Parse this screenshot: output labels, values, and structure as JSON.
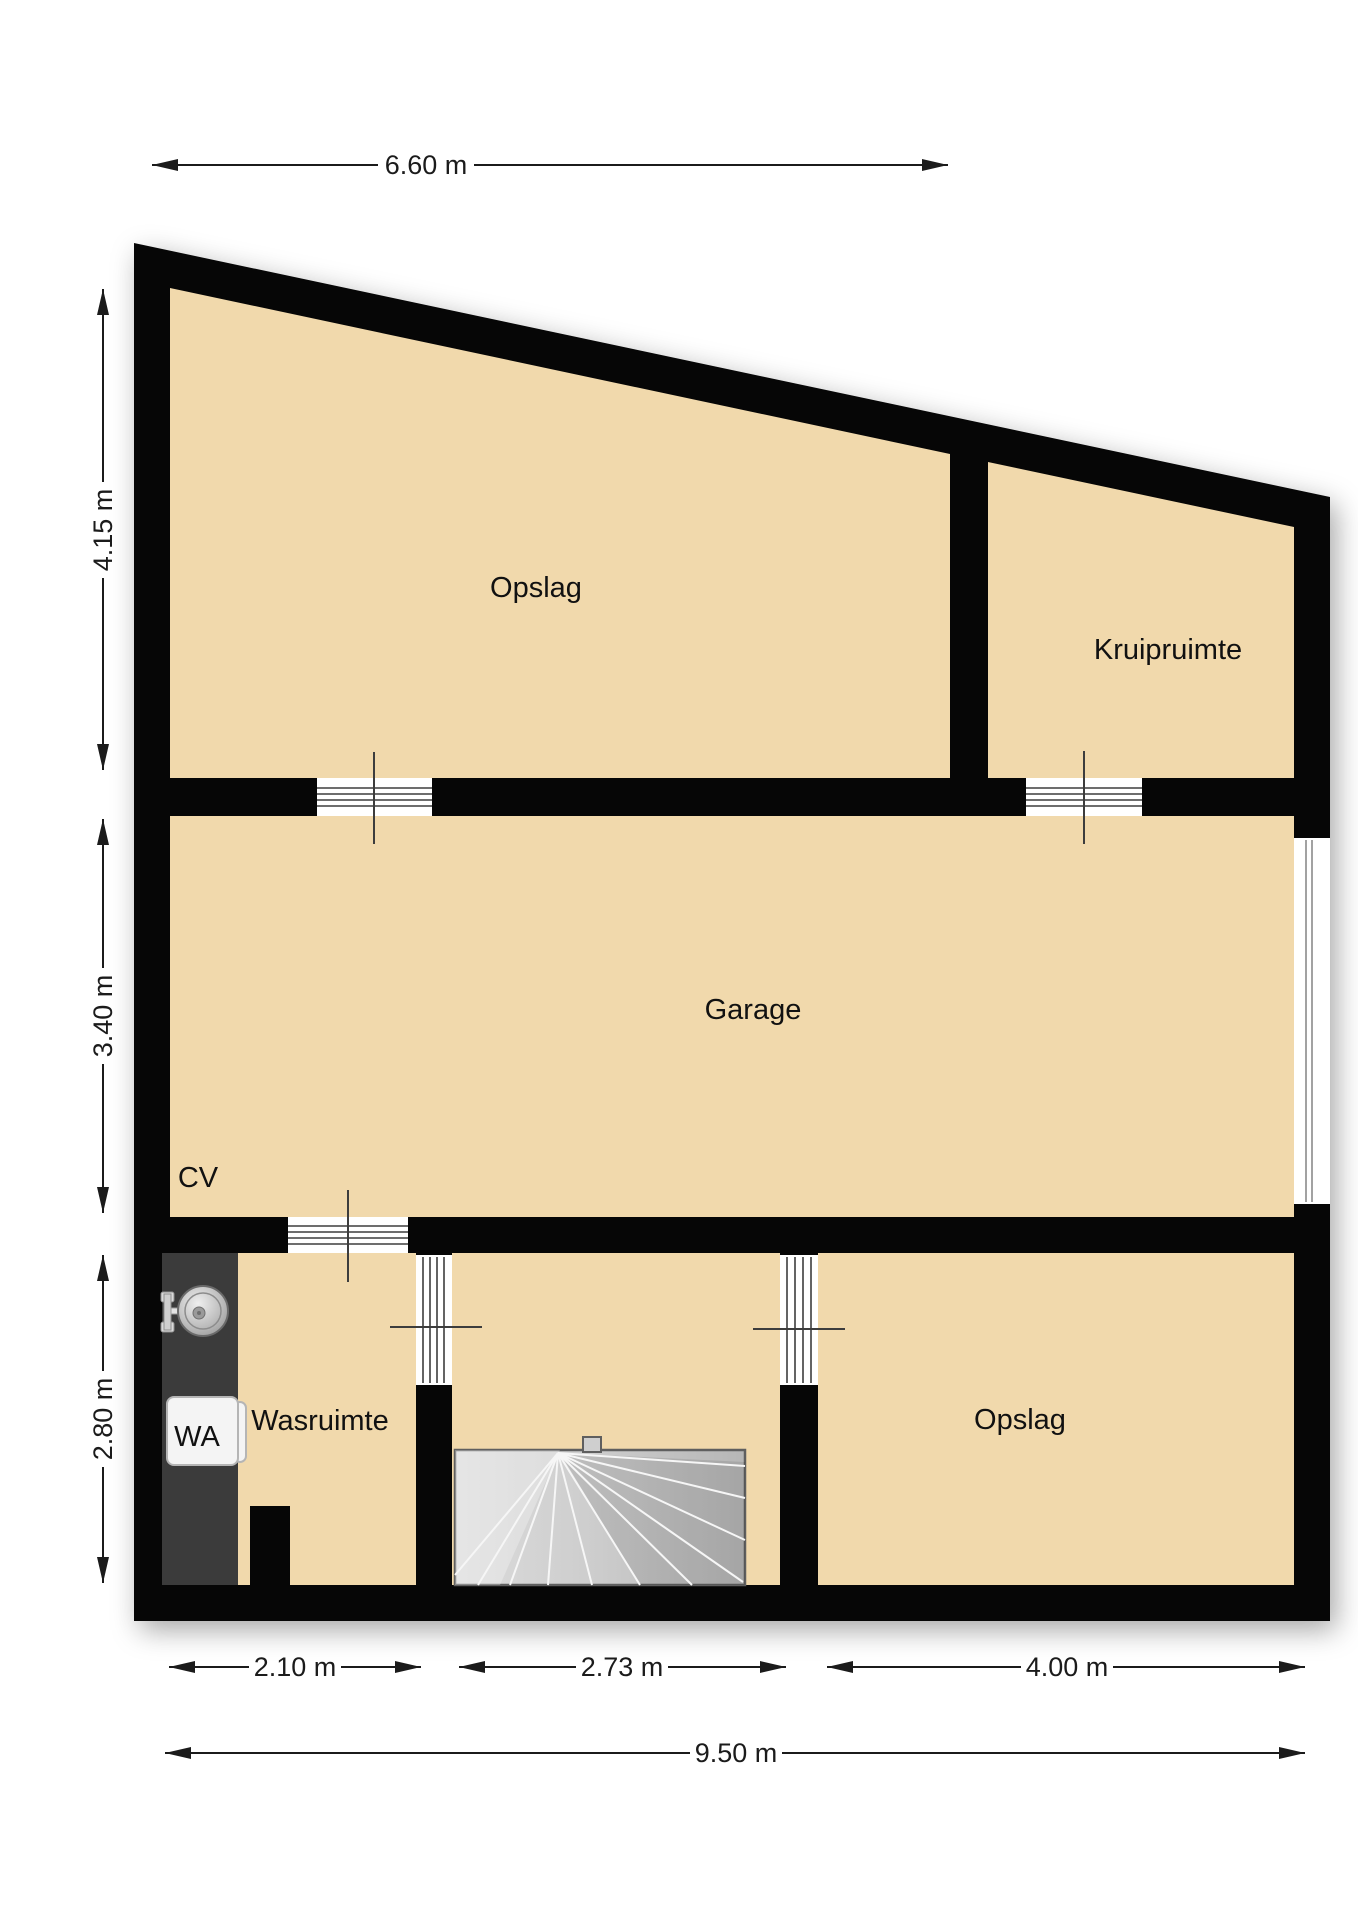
{
  "title": "Floor plan - basement / souterrain",
  "rooms": {
    "opslag_top": "Opslag",
    "kruipruimte": "Kruipruimte",
    "garage": "Garage",
    "cv": "CV",
    "wasruimte": "Wasruimte",
    "opslag_bottom": "Opslag"
  },
  "appliances": {
    "washing_machine": "WA"
  },
  "dimensions": {
    "top": "6.60 m",
    "left_upper": "4.15 m",
    "left_middle": "3.40 m",
    "left_lower": "2.80 m",
    "bottom_left": "2.10 m",
    "bottom_middle": "2.73 m",
    "bottom_right": "4.00 m",
    "bottom_total": "9.50 m"
  },
  "colors": {
    "wall": "#060606",
    "floor": "#f1d9ac",
    "counter": "#3b3b3b",
    "stairs-fill": "#c9c9c9",
    "stairs-border": "#5f5f5f",
    "appliance-fill": "#f4f4f4",
    "appliance-border": "#b5b5b5",
    "door-line": "#3d3d3d",
    "dim": "#1b1b1b",
    "label": "#111111"
  }
}
